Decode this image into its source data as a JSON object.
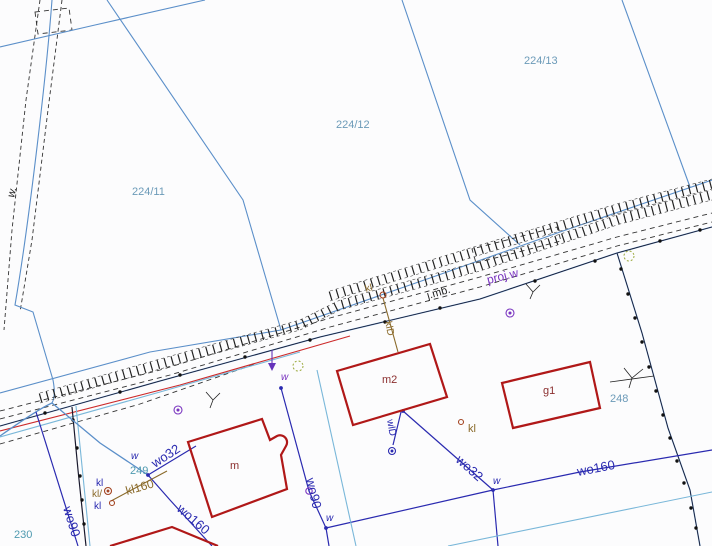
{
  "map": {
    "background": "#fcfcfd",
    "parcel_labels": {
      "p224_11": "224/11",
      "p224_12": "224/12",
      "p224_13": "224/13",
      "p248": "248",
      "p249": "249",
      "p230": "230"
    },
    "building_labels": {
      "m": "m",
      "m2": "m2",
      "g1": "g1"
    },
    "utility_labels": {
      "wo32": "wo32",
      "wo90": "wo90",
      "wo160": "wo160",
      "kl160": "kl160",
      "klD": "klD",
      "wlD": "wlD",
      "kl": "kl",
      "kl_slash": "kl/",
      "w": "w",
      "w_dot": "w.",
      "proj_w": "proj.w",
      "j_mb": "j.mb."
    },
    "colors": {
      "parcel_boundary": "#5b8fc9",
      "water_line": "#2a2ab0",
      "sewer_line": "#8a6a2a",
      "building_outline": "#b01818",
      "auxiliary_cyan": "#79b7d9",
      "utility_red": "#cc2a2a",
      "projected_purple": "#7a35c0",
      "parcel_text": "#6b9ab8",
      "parcel_text_teal": "#4f9ab0",
      "green_symbol": "#9aa83a"
    }
  }
}
